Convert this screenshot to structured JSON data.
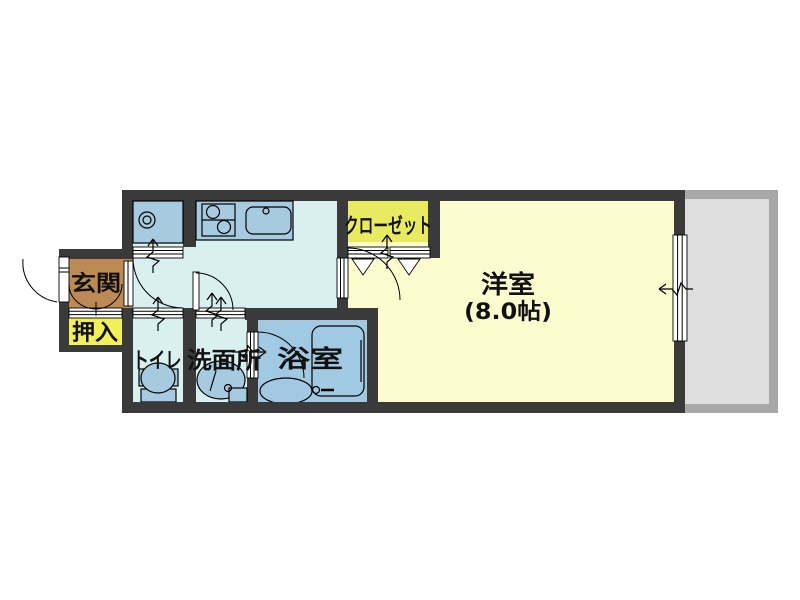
{
  "title": "1K apartment floor plan",
  "colors": {
    "wall": "#3a3a3a",
    "genkan": "#bd8a55",
    "oshiire": "#f2ef5a",
    "closet": "#e8ea60",
    "western": "#fdfccf",
    "floor": "#d9f0f0",
    "fixture": "#a6cbe0",
    "bath": "#a2c9e2",
    "balcony_fill": "#dedede",
    "balcony_border": "#a8a8a8"
  },
  "rooms": {
    "genkan": {
      "label": "玄関"
    },
    "oshiire": {
      "label": "押入"
    },
    "toilet": {
      "label": "トイレ"
    },
    "washroom": {
      "label": "洗面所"
    },
    "bathroom": {
      "label": "浴室"
    },
    "closet": {
      "label": "クローゼット"
    },
    "western": {
      "label": "洋室",
      "size": "(8.0帖)"
    }
  }
}
